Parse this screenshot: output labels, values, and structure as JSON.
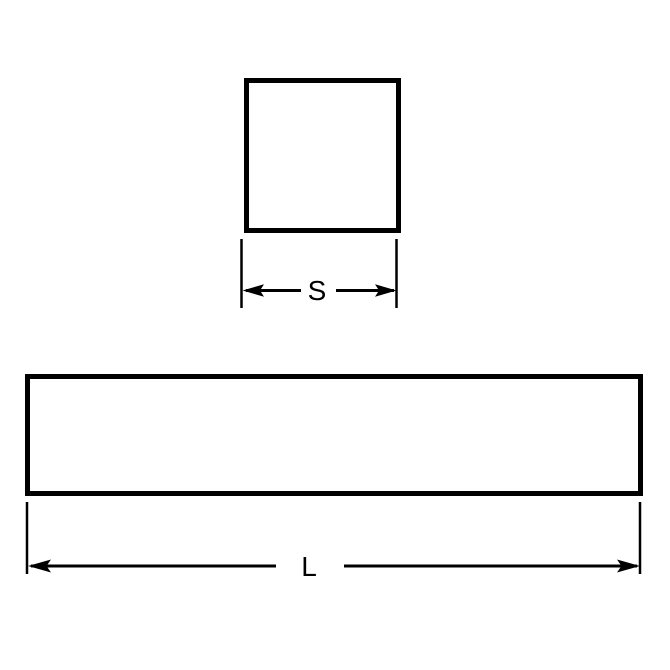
{
  "diagram": {
    "background_color": "#ffffff",
    "line_color": "#000000",
    "top_view": {
      "shape": "square",
      "dimension_label": "S"
    },
    "side_view": {
      "shape": "rectangle",
      "dimension_label": "L"
    }
  }
}
